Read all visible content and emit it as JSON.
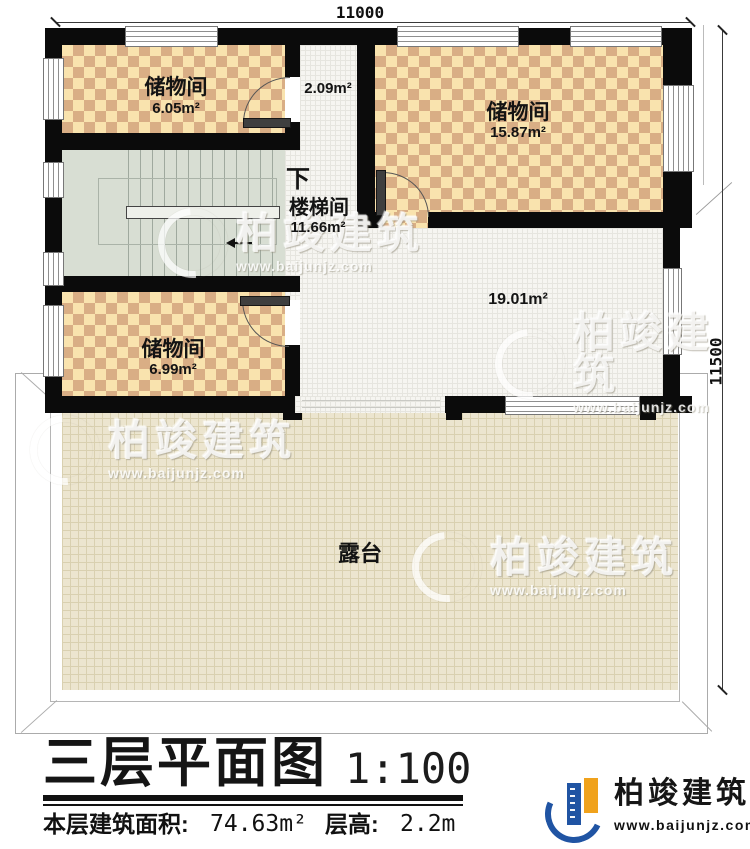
{
  "plan": {
    "dimensions": {
      "top": "11000",
      "right": "11500"
    },
    "rooms": {
      "storage_top_left": {
        "name": "储物间",
        "area": "6.05m²"
      },
      "hallway": {
        "area": "2.09m²"
      },
      "storage_top_right": {
        "name": "储物间",
        "area": "15.87m²"
      },
      "stairwell": {
        "name": "楼梯间",
        "area": "11.66m²",
        "direction": "下"
      },
      "storage_mid_left": {
        "name": "储物间",
        "area": "6.99m²"
      },
      "open_area": {
        "area": "19.01m²"
      },
      "terrace": {
        "name": "露台"
      }
    }
  },
  "watermark": {
    "text": "柏竣建筑",
    "url": "www.baijunjz.com"
  },
  "title_block": {
    "title": "三层平面图",
    "scale": "1:100",
    "floor_area_label": "本层建筑面积:",
    "floor_area_value": "74.63m²",
    "floor_height_label": "层高:",
    "floor_height_value": "2.2m"
  },
  "branding": {
    "name": "柏竣建筑",
    "url": "www.baijunjz.com"
  },
  "colors": {
    "wall": "#0b0b0b",
    "checker_light": "#f9e3ae",
    "checker_dark": "#d9ae85",
    "stair": "#d8ded3",
    "tile_floor": "#f6f5f1",
    "terrace": "#ece5cf",
    "logo_blue": "#2054a3",
    "logo_orange": "#f0a21c"
  }
}
